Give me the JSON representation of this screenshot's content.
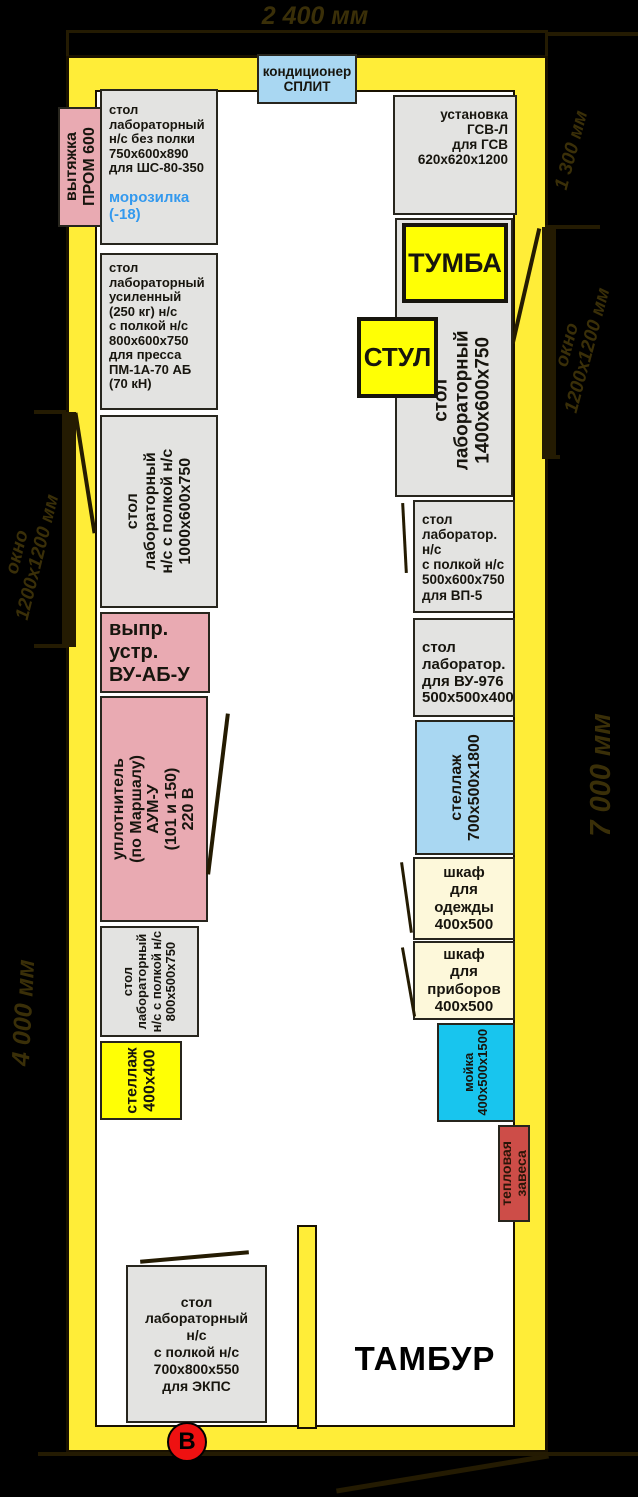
{
  "dims": {
    "top": "2 400 мм",
    "right_top": "1 300 мм",
    "right_full": "7 000 мм",
    "left_bottom": "4 000 мм"
  },
  "windows": {
    "left": {
      "line1": "окно",
      "line2": "1200х1200 мм"
    },
    "right": {
      "line1": "окно",
      "line2": "1200х1200 мм"
    }
  },
  "labels": {
    "tambur": "ТАМБУР",
    "entrance": "В"
  },
  "colors": {
    "wall": "#ffed38",
    "furniture_gray": "#e3e3e1",
    "furniture_pink": "#e9aab2",
    "furniture_blue": "#a9d7f2",
    "furniture_cyan": "#18c5ee",
    "furniture_cream": "#fdf8da",
    "furniture_red": "#cd4d48",
    "furniture_yellow": "#ffff05",
    "dimension_text": "#3a2f08",
    "entrance_mark": "#ee1111",
    "freezer_text": "#3399ee"
  },
  "furniture": {
    "hood": {
      "l1": "вытяжка",
      "l2": "ПРОМ 600"
    },
    "ac": {
      "l1": "кондиционер",
      "l2": "СПЛИТ"
    },
    "t_shs": {
      "l1": "стол",
      "l2": "лабораторный",
      "l3": "н/с без полки",
      "l4": "750х600х890",
      "l5": "для ШС-80-350"
    },
    "freezer": {
      "l1": "морозилка",
      "l2": "(-18)"
    },
    "t_press": {
      "l1": "стол",
      "l2": "лабораторный",
      "l3": "усиленный",
      "l4": "(250 кг) н/с",
      "l5": "с полкой н/с",
      "l6": "800х600х750",
      "l7": "для пресса",
      "l8": "ПМ-1А-70 АБ",
      "l9": "(70 кН)"
    },
    "t_1000": {
      "l1": "стол",
      "l2": "лабораторный",
      "l3": "н/с с полкой н/с",
      "l4": "1000х600х750"
    },
    "rectifier": {
      "l1": "выпр.",
      "l2": "устр.",
      "l3": "ВУ-АБ-У"
    },
    "compactor": {
      "l1": "уплотнитель",
      "l2": "(по Маршалу)",
      "l3": "АУМ-У",
      "l4": "(101 и 150)",
      "l5": "220 В"
    },
    "t_800": {
      "l1": "стол",
      "l2": "лабораторный",
      "l3": "н/с с полкой н/с",
      "l4": "800х500х750"
    },
    "rack_400": {
      "l1": "стеллаж",
      "l2": "400х400"
    },
    "gsv": {
      "l1": "установка",
      "l2": "ГСВ-Л",
      "l3": "для ГСВ",
      "l4": "620х620х1200"
    },
    "tumba": "ТУМБА",
    "stul": "СТУЛ",
    "t_1400": {
      "l1": "стол",
      "l2": "лабораторный",
      "l3": "1400х600х750"
    },
    "t_vp5": {
      "l1": "стол",
      "l2": "лаборатор.",
      "l3": "н/с",
      "l4": "с полкой н/с",
      "l5": "500х600х750",
      "l6": "для ВП-5"
    },
    "t_vu976": {
      "l1": "стол",
      "l2": "лаборатор.",
      "l3": "для ВУ-976",
      "l4": "500х500х400"
    },
    "rack_700": {
      "l1": "стеллаж",
      "l2": "700х500х1800"
    },
    "wardrobe": {
      "l1": "шкаф",
      "l2": "для",
      "l3": "одежды",
      "l4": "400х500"
    },
    "instrument_cab": {
      "l1": "шкаф",
      "l2": "для",
      "l3": "приборов",
      "l4": "400х500"
    },
    "sink": {
      "l1": "мойка",
      "l2": "400х500х1500"
    },
    "curtain": {
      "l1": "тепловая",
      "l2": "завеса"
    },
    "t_ekps": {
      "l1": "стол",
      "l2": "лабораторный",
      "l3": "н/с",
      "l4": "с полкой н/с",
      "l5": "700х800х550",
      "l6": "для ЭКПС"
    }
  }
}
